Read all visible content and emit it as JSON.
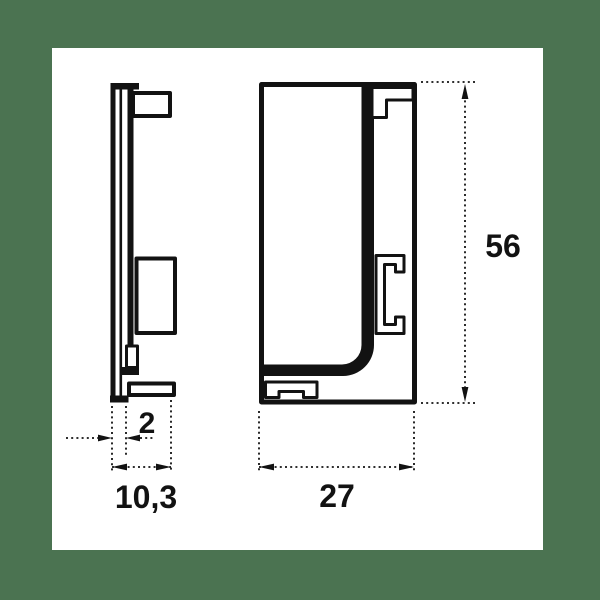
{
  "page": {
    "background_color": "#4b7351",
    "paper_color": "#ffffff",
    "line_color": "#121212"
  },
  "drawing": {
    "dimensions": {
      "thickness": "2",
      "depth": "10,3",
      "width": "27",
      "height": "56"
    }
  }
}
